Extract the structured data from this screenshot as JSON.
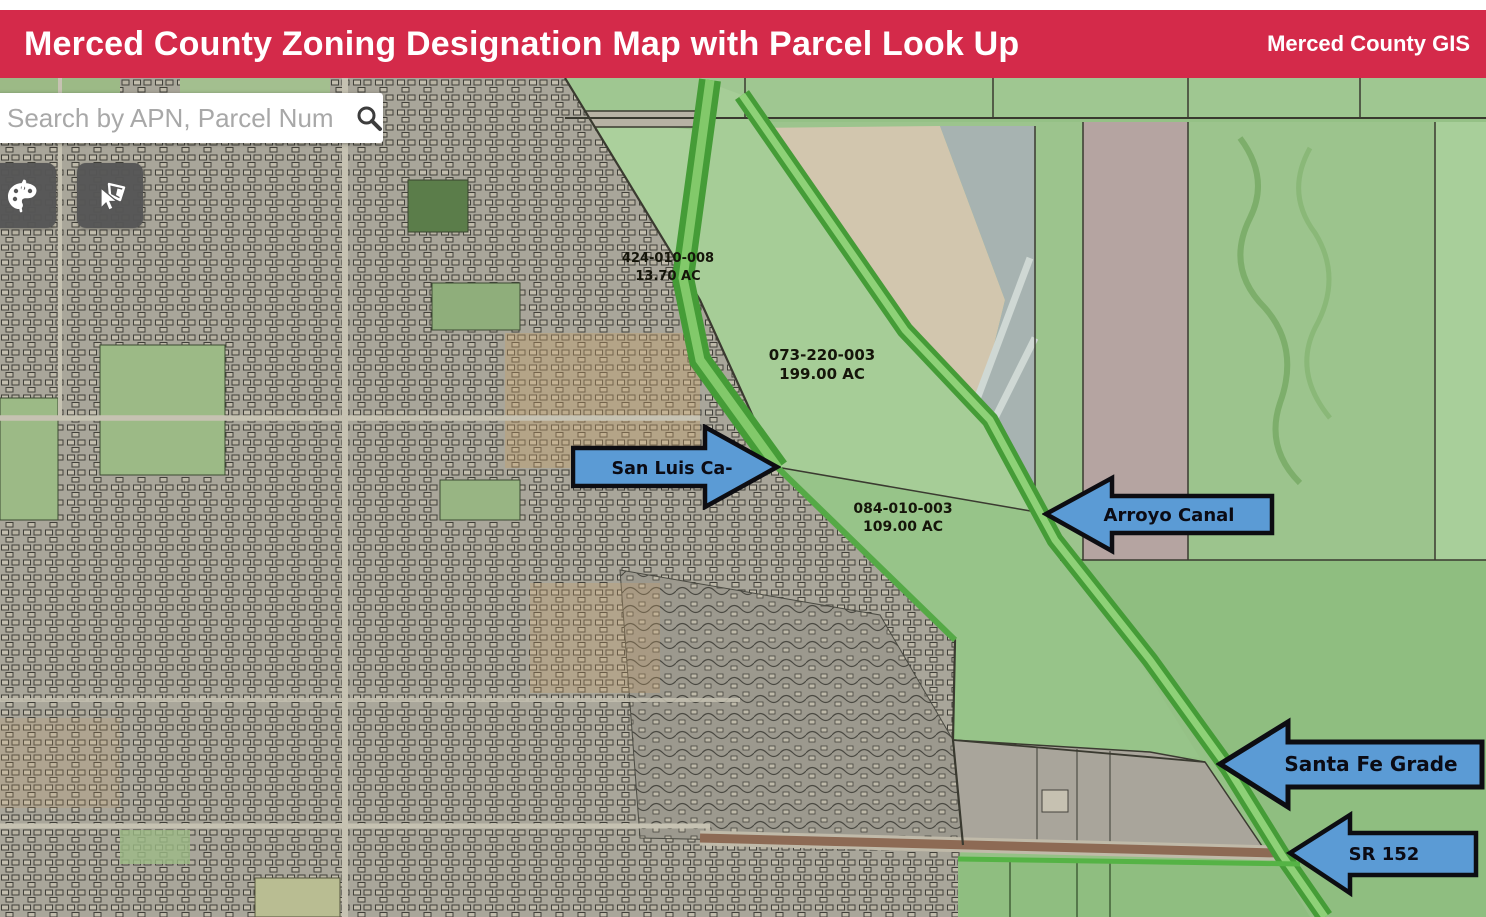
{
  "header": {
    "title": "Merced County Zoning Designation Map with Parcel Look Up",
    "brand": "Merced County GIS"
  },
  "search": {
    "placeholder": "Search by APN, Parcel Num",
    "value": ""
  },
  "toolbar": {
    "basemap_button": "basemap gallery",
    "select_button": "select parcel"
  },
  "icons": {
    "search": "magnifier-icon",
    "basemap": "palette-icon",
    "select": "select-parcel-icon"
  },
  "map": {
    "parcels": [
      {
        "apn": "424-010-008",
        "acres": "13.70 AC"
      },
      {
        "apn": "073-220-003",
        "acres": "199.00 AC"
      },
      {
        "apn": "084-010-003",
        "acres": "109.00 AC"
      }
    ],
    "callouts": [
      {
        "label": "San Luis Ca-",
        "direction": "right"
      },
      {
        "label": "Arroyo Canal",
        "direction": "left"
      },
      {
        "label": "Santa Fe Grade",
        "direction": "left"
      },
      {
        "label": "SR 152",
        "direction": "left"
      }
    ]
  },
  "colors": {
    "header_red": "#d42a4a",
    "callout_blue": "#5b9bd5",
    "canal_green": "#55b345",
    "field_green": "#9dc88e",
    "urban_gray": "#a9a69a"
  }
}
